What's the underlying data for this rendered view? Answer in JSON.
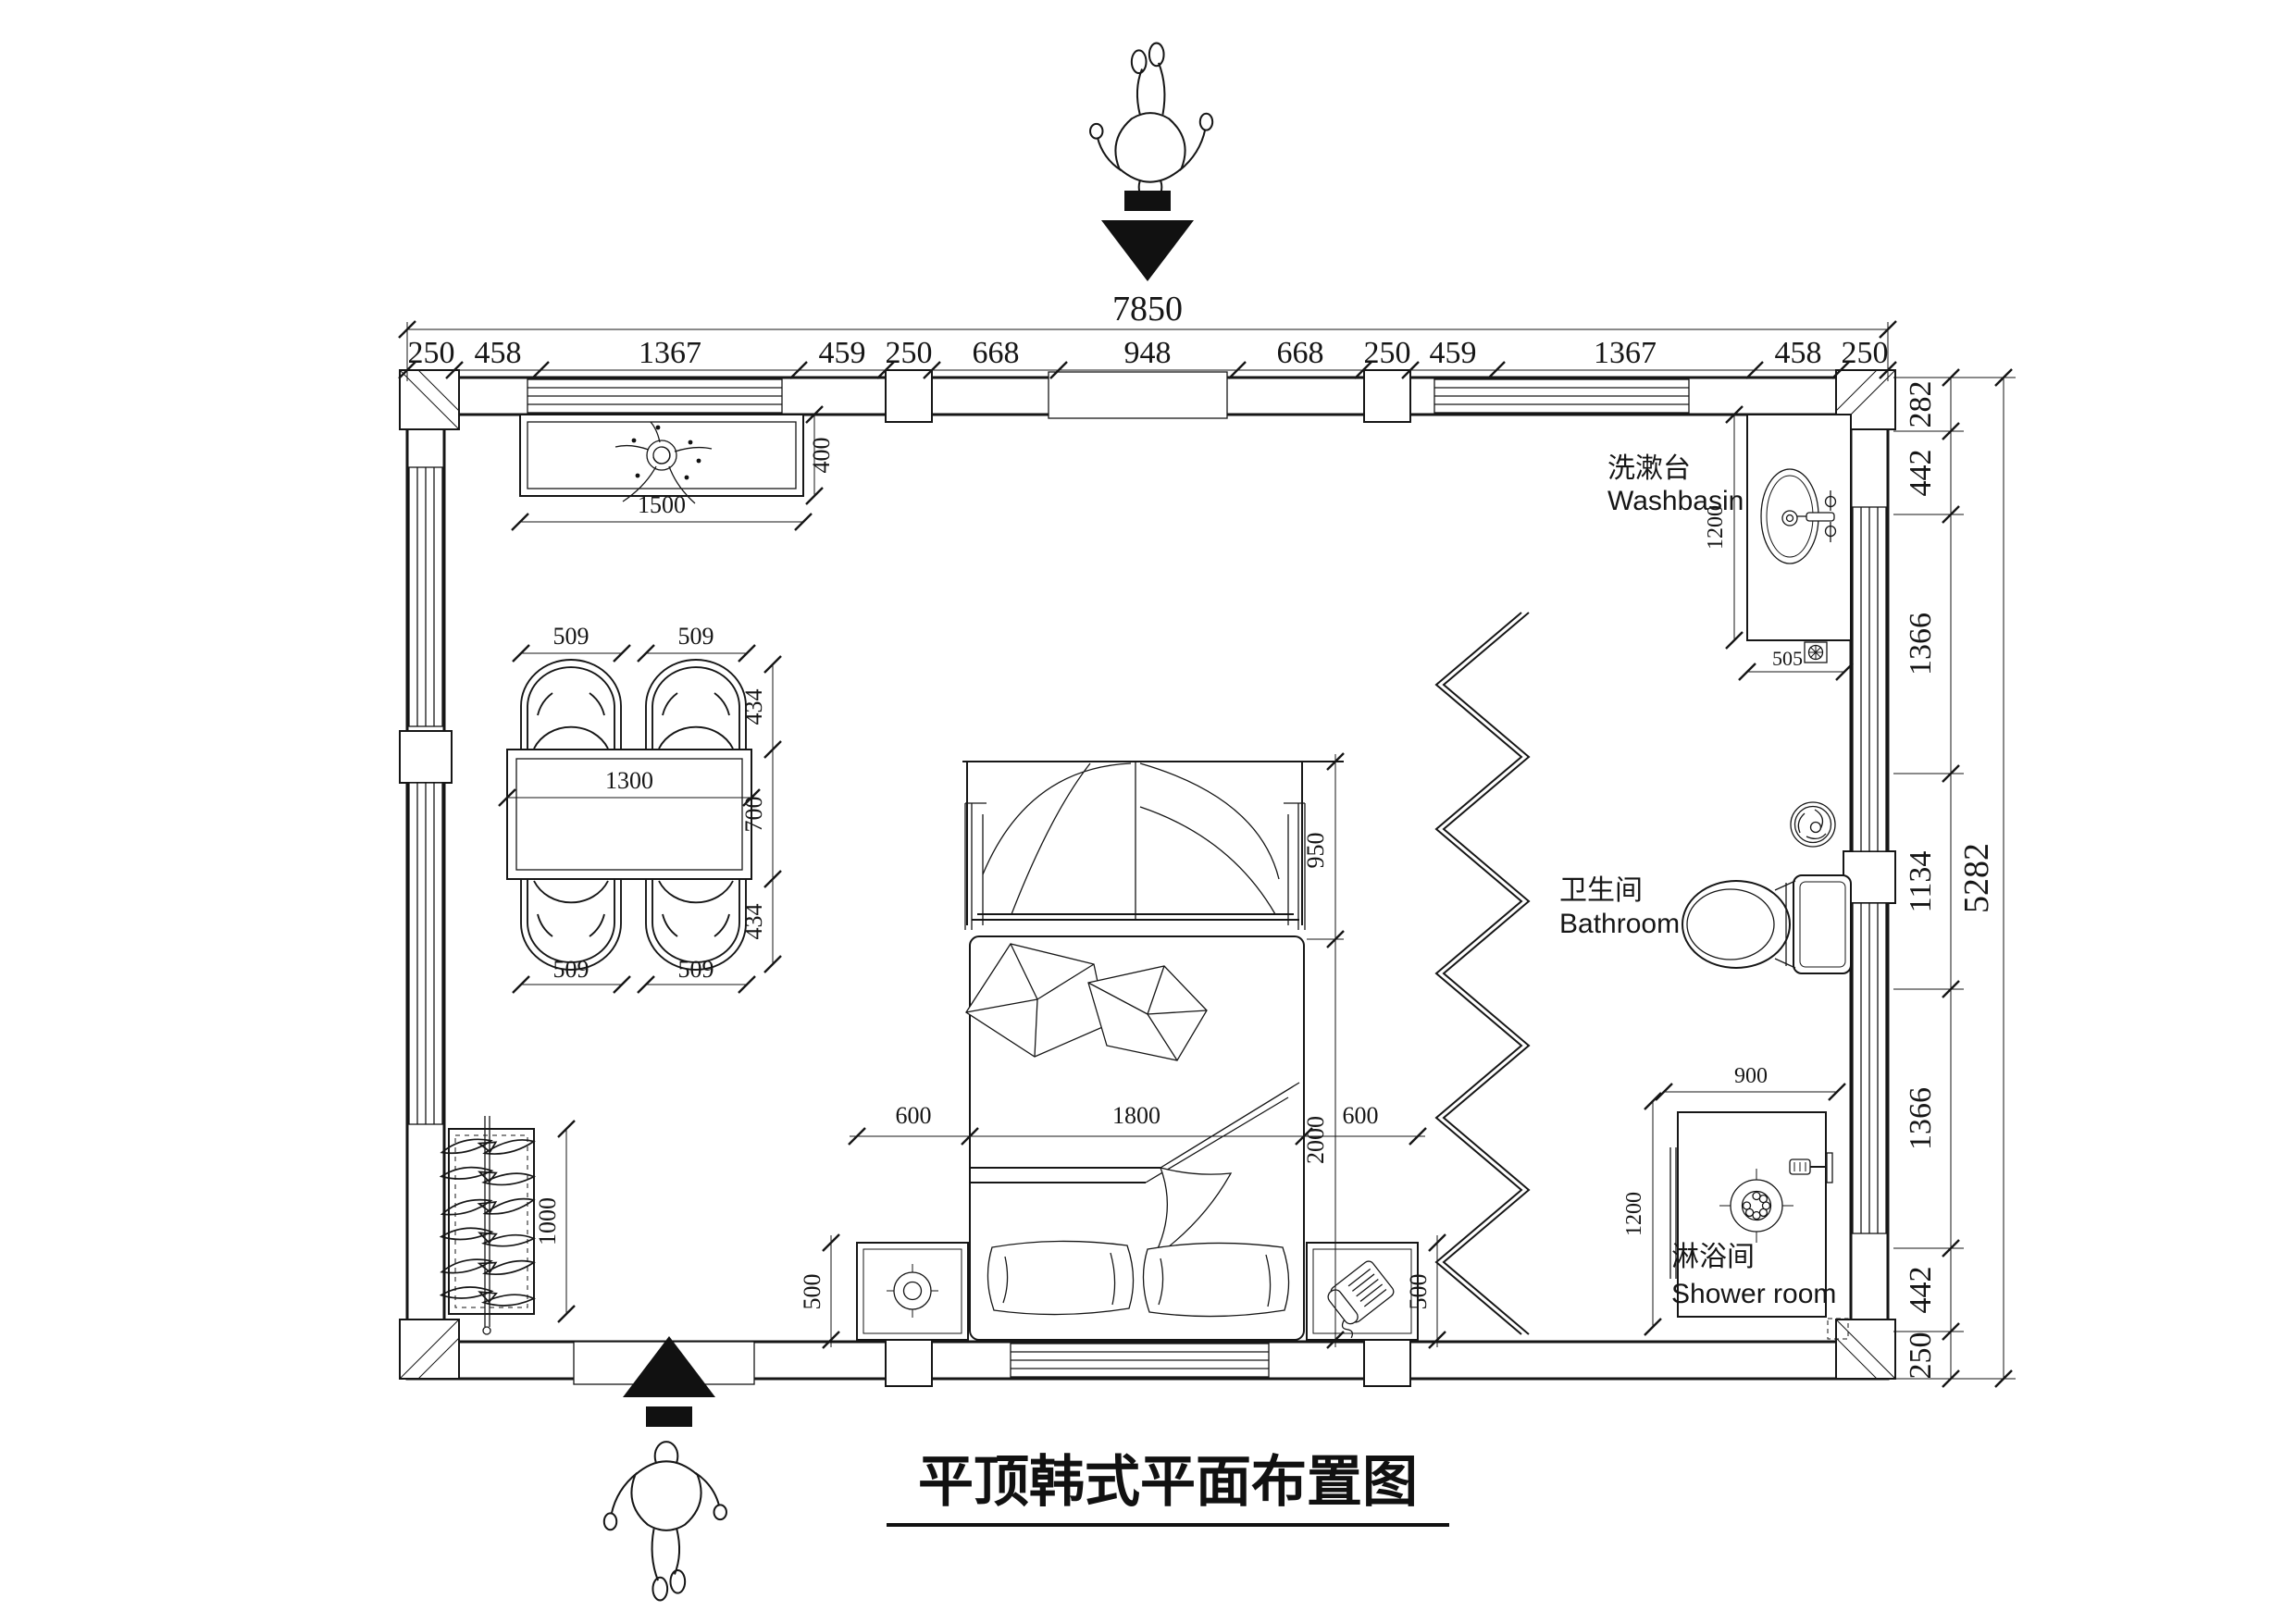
{
  "title": "平顶韩式平面布置图",
  "colors": {
    "ink": "#161616",
    "background": "#ffffff"
  },
  "rooms": {
    "washbasin_zh": "洗漱台",
    "washbasin_en": "Washbasin",
    "bathroom_zh": "卫生间",
    "bathroom_en": "Bathroom",
    "shower_zh": "淋浴间",
    "shower_en": "Shower room"
  },
  "dims": {
    "top_total": "7850",
    "top_segments": [
      "250",
      "458",
      "1367",
      "459",
      "250",
      "668",
      "948",
      "668",
      "250",
      "459",
      "1367",
      "458",
      "250"
    ],
    "right_total": "5282",
    "right_segments": [
      "282",
      "442",
      "1366",
      "1134",
      "1366",
      "442",
      "250"
    ],
    "cabinet_width": "1500",
    "cabinet_depth": "400",
    "dining_chair": [
      "509",
      "509",
      "509",
      "509"
    ],
    "dining_table_width": "1300",
    "dining_side": [
      "434",
      "700",
      "434"
    ],
    "rack_height": "1000",
    "bed_canopy": "950",
    "bed_length": "2000",
    "bed_width": "1800",
    "nightstand_left_width": "600",
    "nightstand_right_width": "600",
    "nightstand_left_depth": "500",
    "nightstand_right_depth": "500",
    "basin_depth": "1200",
    "basin_drain": "505",
    "shower_width": "900",
    "shower_depth": "1200"
  },
  "icons": {
    "entry_top": "person-top-view",
    "entry_top_arrow": "down-arrow",
    "entry_bottom": "person-top-view",
    "entry_bottom_arrow": "up-arrow",
    "plant": "potted-plant",
    "lamp": "round-lamp",
    "telephone": "desk-phone",
    "toilet": "toilet",
    "washbasin": "oval-basin",
    "spiral_drain": "floor-drain",
    "shower_drain": "shower-drain",
    "folding_door": "accordion-partition"
  }
}
